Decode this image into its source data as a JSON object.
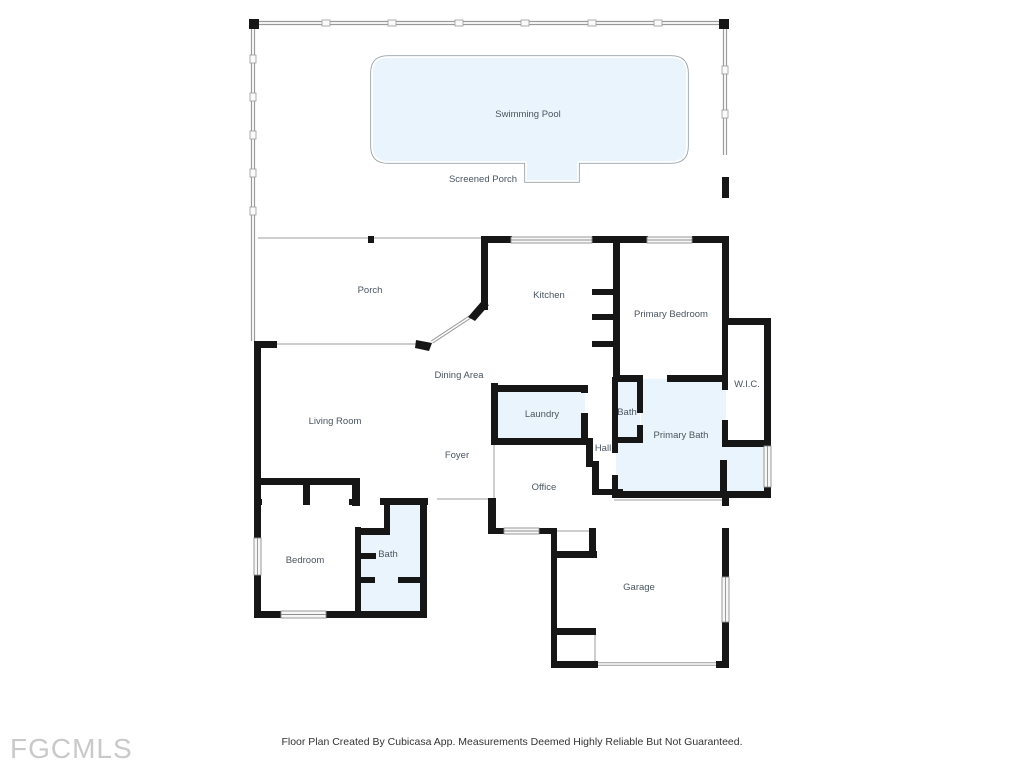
{
  "title": "Residential Floor Plan",
  "footer": {
    "disclaimer": "Floor Plan Created By Cubicasa App. Measurements Deemed Highly Reliable But Not Guaranteed.",
    "logo": "FGCMLS"
  },
  "colors": {
    "wall": "#161616",
    "wet_area": "#e9f4fc",
    "screen_line": "#9a9a9a",
    "thin_line": "#bdbdbd",
    "window_fill": "#f7f7f7",
    "window_stroke": "#8f8f8f",
    "label": "#4a5560"
  },
  "rooms": [
    {
      "id": "swimming-pool",
      "label": "Swimming Pool",
      "x": 528,
      "y": 117
    },
    {
      "id": "screened-porch",
      "label": "Screened Porch",
      "x": 483,
      "y": 182
    },
    {
      "id": "porch",
      "label": "Porch",
      "x": 370,
      "y": 293
    },
    {
      "id": "kitchen",
      "label": "Kitchen",
      "x": 549,
      "y": 298
    },
    {
      "id": "primary-bedroom",
      "label": "Primary Bedroom",
      "x": 671,
      "y": 317
    },
    {
      "id": "dining-area",
      "label": "Dining Area",
      "x": 459,
      "y": 378
    },
    {
      "id": "wic",
      "label": "W.I.C.",
      "x": 747,
      "y": 387
    },
    {
      "id": "laundry",
      "label": "Laundry",
      "x": 542,
      "y": 417
    },
    {
      "id": "bath-primary-small",
      "label": "Bath",
      "x": 627,
      "y": 415
    },
    {
      "id": "living-room",
      "label": "Living Room",
      "x": 335,
      "y": 424
    },
    {
      "id": "primary-bath",
      "label": "Primary Bath",
      "x": 681,
      "y": 438
    },
    {
      "id": "hall",
      "label": "Hall",
      "x": 603,
      "y": 451
    },
    {
      "id": "foyer",
      "label": "Foyer",
      "x": 457,
      "y": 458
    },
    {
      "id": "office",
      "label": "Office",
      "x": 544,
      "y": 490
    },
    {
      "id": "bath-hall",
      "label": "Bath",
      "x": 388,
      "y": 557
    },
    {
      "id": "bedroom",
      "label": "Bedroom",
      "x": 305,
      "y": 563
    },
    {
      "id": "garage",
      "label": "Garage",
      "x": 639,
      "y": 590
    }
  ]
}
